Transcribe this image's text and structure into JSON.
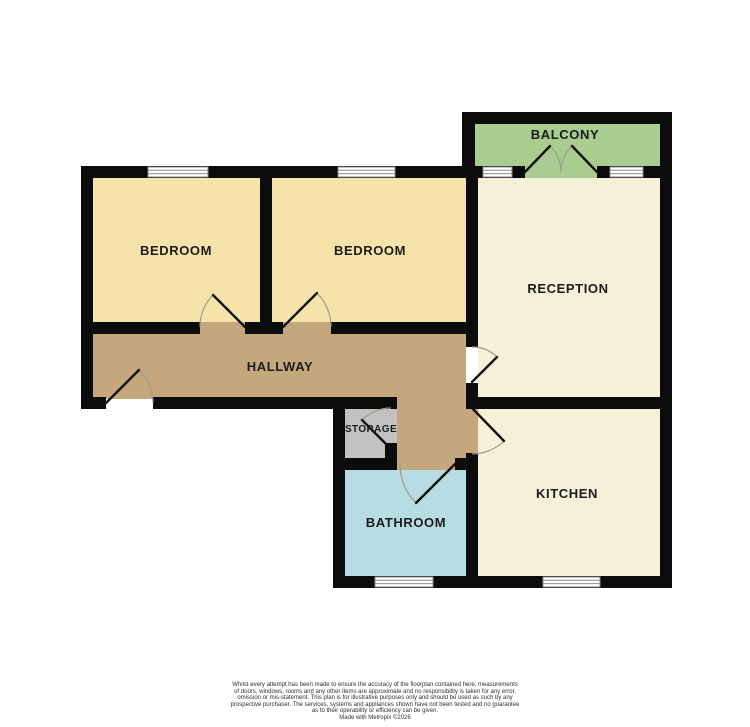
{
  "floorplan": {
    "rooms": {
      "balcony": {
        "label": "BALCONY",
        "color": "#a9cc91"
      },
      "bedroom1": {
        "label": "BEDROOM",
        "color": "#f5e3aa"
      },
      "bedroom2": {
        "label": "BEDROOM",
        "color": "#f5e3aa"
      },
      "reception": {
        "label": "RECEPTION",
        "color": "#f7f0d8"
      },
      "kitchen": {
        "label": "KITCHEN",
        "color": "#f7f0d8"
      },
      "hallway": {
        "label": "HALLWAY",
        "color": "#c5a77d"
      },
      "storage": {
        "label": "STORAGE",
        "color": "#c3c2c1"
      },
      "bathroom": {
        "label": "BATHROOM",
        "color": "#b7dce3"
      }
    },
    "style": {
      "wall_color": "#0b0b0b",
      "window_fill": "#ffffff",
      "window_frame": "#8b8b8b",
      "door_leaf_color": "#111111",
      "door_arc_color": "#9b9b90",
      "label_color": "#1c1c1c"
    }
  },
  "disclaimer": {
    "lines": [
      "Whilst every attempt has been made to ensure the accuracy of the floorplan contained here, measurements",
      "of doors, windows, rooms and any other items are approximate and no responsibility is taken for any error,",
      "omission or mis-statement. This plan is for illustrative purposes only and should be used as such by any",
      "prospective purchaser. The services, systems and appliances shown have not been tested and no guarantee",
      "as to their operability or efficiency can be given.",
      "Made with Metropix ©2026"
    ]
  }
}
